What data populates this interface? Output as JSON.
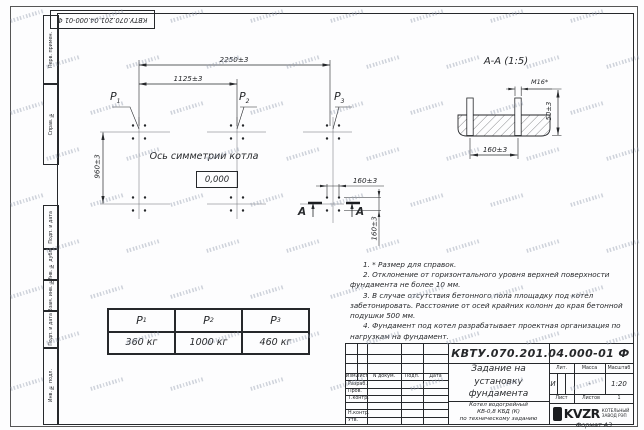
{
  "colors": {
    "paper": "#fdfdfe",
    "ink": "#26282b",
    "watermark": "#94a0b0"
  },
  "doc": {
    "number": "КВТУ.070.201.04.000-01 Ф",
    "format": "Формат А3"
  },
  "frame": {
    "top_cells": [
      "Перв. примен.",
      "Справ. №"
    ],
    "bottom_cells": [
      "Подп. и дата",
      "Инв. № дубл.",
      "Взам. инв. №",
      "Подп. и дата",
      "Инв. № подл."
    ]
  },
  "plan": {
    "dims": {
      "total_width": "2250±3",
      "half_width": "1125±3",
      "height": "960±3",
      "bolt_spacing_x": "160±3",
      "bolt_spacing_y": "160±3"
    },
    "axis_text": "Ось симметрии котла",
    "level_text": "0,000",
    "section_letter": "А"
  },
  "section_view": {
    "title": "А-А (1:5)",
    "bolt_thread": "М16*",
    "dim_height": "50±3",
    "dim_spacing": "160±3"
  },
  "loads": {
    "labels": [
      {
        "base": "P",
        "sub": "1"
      },
      {
        "base": "P",
        "sub": "2"
      },
      {
        "base": "P",
        "sub": "3"
      }
    ],
    "values": [
      "360 кг",
      "1000 кг",
      "460 кг"
    ]
  },
  "notes": [
    "1. * Размер для справок.",
    "2. Отклонение от горизонтального уровня верхней поверхности фундамента не более 10 мм.",
    "3. В случае отсутствия бетонного пола площадку под котел забетонировать. Расстояние от осей крайних колонн до края бетонной подушки 500 мм.",
    "4. Фундамент под котел разрабатывает проектная организация по нагрузкам на фундамент."
  ],
  "title_block": {
    "doc_number": "КВТУ.070.201.04.000-01 Ф",
    "title_lines": [
      "Задание на",
      "установку",
      "фундамента"
    ],
    "product_lines": [
      "Котел водогрейный",
      "КВ-0,8 КБД (К)",
      "по техническому заданию"
    ],
    "columns": [
      "Изм.",
      "Лист",
      "N докум.",
      "Подп.",
      "Дата"
    ],
    "rows": [
      "Разраб.",
      "Пров.",
      "Т.контр.",
      "",
      "Н.контр.",
      "Утв."
    ],
    "lit": {
      "label": "Лит.",
      "value": "И"
    },
    "mass": {
      "label": "Масса",
      "value": "-"
    },
    "scale": {
      "label": "Масштаб",
      "value": "1:20"
    },
    "sheet": {
      "label": "Лист"
    },
    "sheets": {
      "label": "Листов",
      "value": "1"
    },
    "logo": {
      "name": "KVZR",
      "line1": "КОТЕЛЬНЫЙ",
      "line2": "ЗАВОД РЭП"
    }
  }
}
